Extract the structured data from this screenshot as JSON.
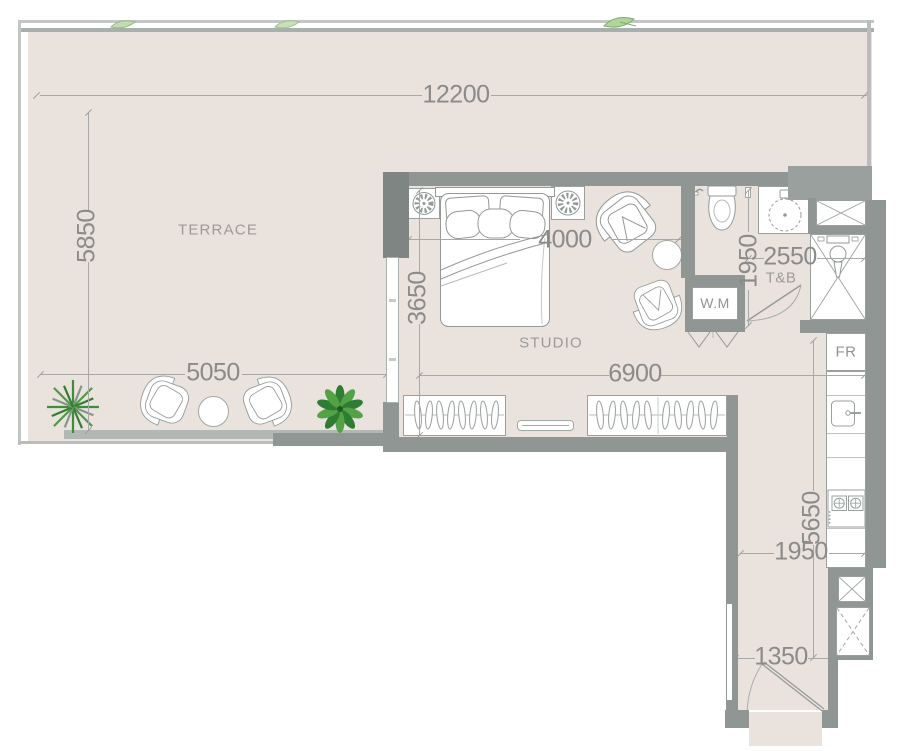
{
  "plan": {
    "rooms": {
      "terrace": "TERRACE",
      "studio": "STUDIO",
      "bath": "T&B",
      "washer": "W.M",
      "fridge": "FR"
    },
    "dims": {
      "overall_width": "12200",
      "terrace_depth": "5850",
      "terrace_seating": "5050",
      "bed_zone": "4000",
      "studio_depth": "3650",
      "studio_width": "6900",
      "bath_depth": "1950",
      "bath_width": "2550",
      "kitchen_run": "5650",
      "corridor_width": "1950",
      "entry_width": "1350"
    },
    "colors": {
      "floor": "#e9e2dd",
      "wall": "#8f9694",
      "wall_dark": "#7e8583",
      "dim_line": "#a8a8a8",
      "dim_text": "#8b8b8b",
      "plant_green": "#3c8f3a",
      "fixture_white": "#ffffff"
    }
  }
}
